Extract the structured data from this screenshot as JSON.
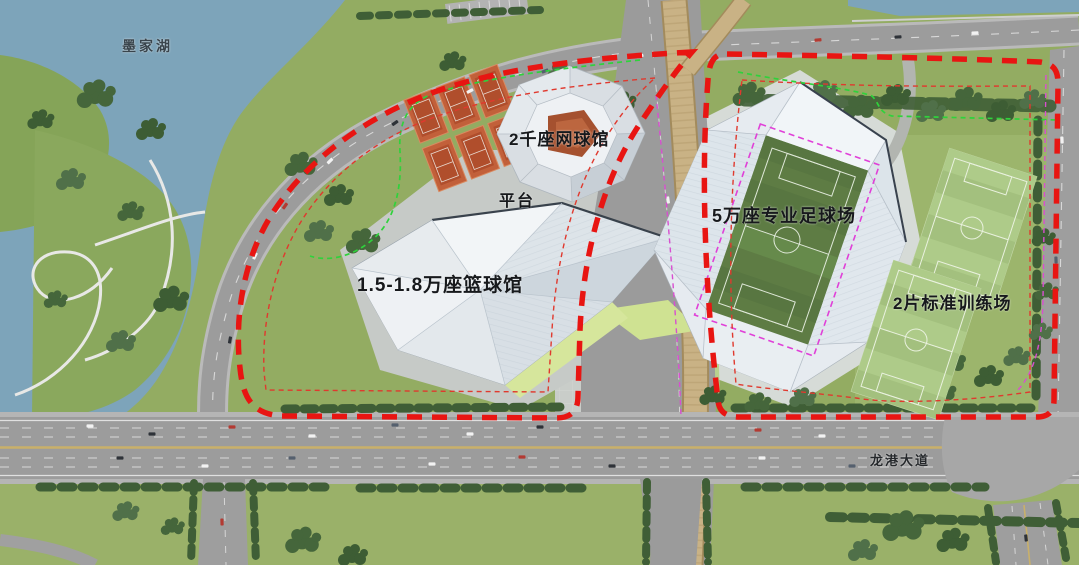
{
  "plan": {
    "labels": {
      "lake": "墨家湖",
      "tennis_hall": "2千座网球馆",
      "platform": "平台",
      "basketball_arena": "1.5-1.8万座篮球馆",
      "football_stadium": "5万座专业足球场",
      "training_fields": "2片标准训练场",
      "avenue": "龙港大道"
    },
    "colors": {
      "site_boundary_red": "#e81512",
      "inner_boundary_red": "#e0392e",
      "green_line": "#2fd23c",
      "magenta_line": "#d84fd0",
      "pitch_magenta": "#e040d8",
      "water": "#7da4ba",
      "lawn": "#93ac62",
      "road": "#9c9c9c",
      "bridge": "#c9b285",
      "tennis_court": "#bf5c36",
      "stadium_pitch": "#5e7c44",
      "training_pitch": "#a3c07e",
      "roof_white": "#e6ebf0"
    }
  }
}
